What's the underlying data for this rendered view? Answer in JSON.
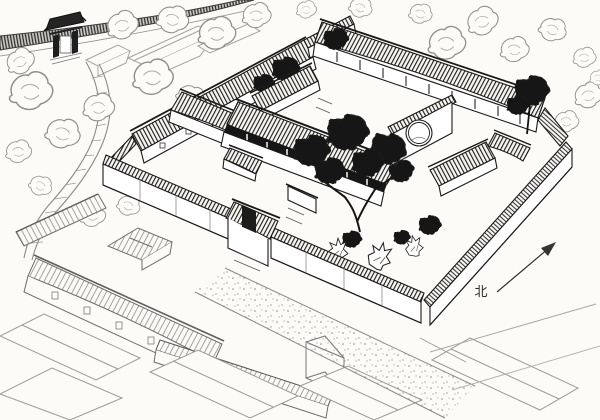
{
  "figure": {
    "description_role": "hand-drawn aerial line illustration of a traditional Chinese siheyuan courtyard compound",
    "compass": {
      "label": "北"
    },
    "palette": {
      "ink": "#1a1a1a",
      "mid_ink": "#555555",
      "light_ink": "#9a9a9a",
      "paper": "#fcfbf8"
    }
  }
}
